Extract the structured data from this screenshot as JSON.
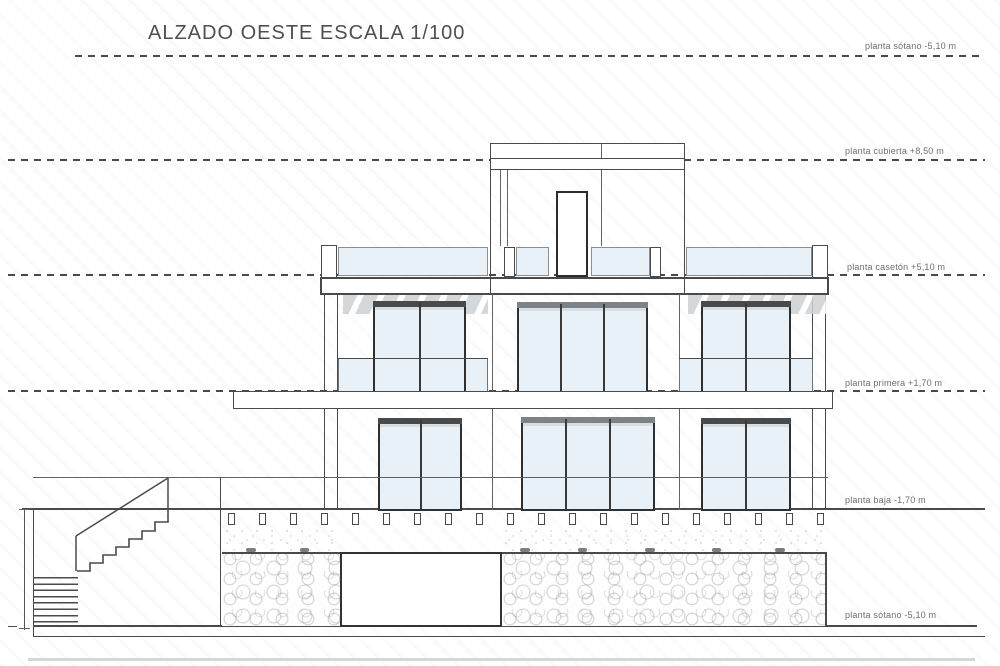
{
  "title": "ALZADO OESTE ESCALA 1/100",
  "levels": [
    {
      "label": "planta sótano -5,10 m",
      "value": "-5,10 m",
      "name": "planta sótano",
      "line_style": "dashed"
    },
    {
      "label": "planta cubierta +8,50 m",
      "value": "+8,50 m",
      "name": "planta cubierta",
      "line_style": "dashed"
    },
    {
      "label": "planta casetón +5,10 m",
      "value": "+5,10 m",
      "name": "planta casetón",
      "line_style": "dashed"
    },
    {
      "label": "planta primera +1,70 m",
      "value": "+1,70 m",
      "name": "planta primera",
      "line_style": "dashed"
    },
    {
      "label": "planta baja -1,70 m",
      "value": "-1,70 m",
      "name": "planta baja",
      "line_style": "solid"
    },
    {
      "label": "planta sótano -5,10 m",
      "value": "-5,10 m",
      "name": "planta sótano",
      "line_style": "solid"
    }
  ],
  "colors": {
    "ink": "#4a4a4a",
    "ink_2": "#5f6368",
    "ink_light": "#6e6e6e",
    "title": "#4b5055",
    "glass": "#e9f1f8",
    "glass_dark": "#d9dee3",
    "hatch_gray": "#cdd1d4"
  }
}
